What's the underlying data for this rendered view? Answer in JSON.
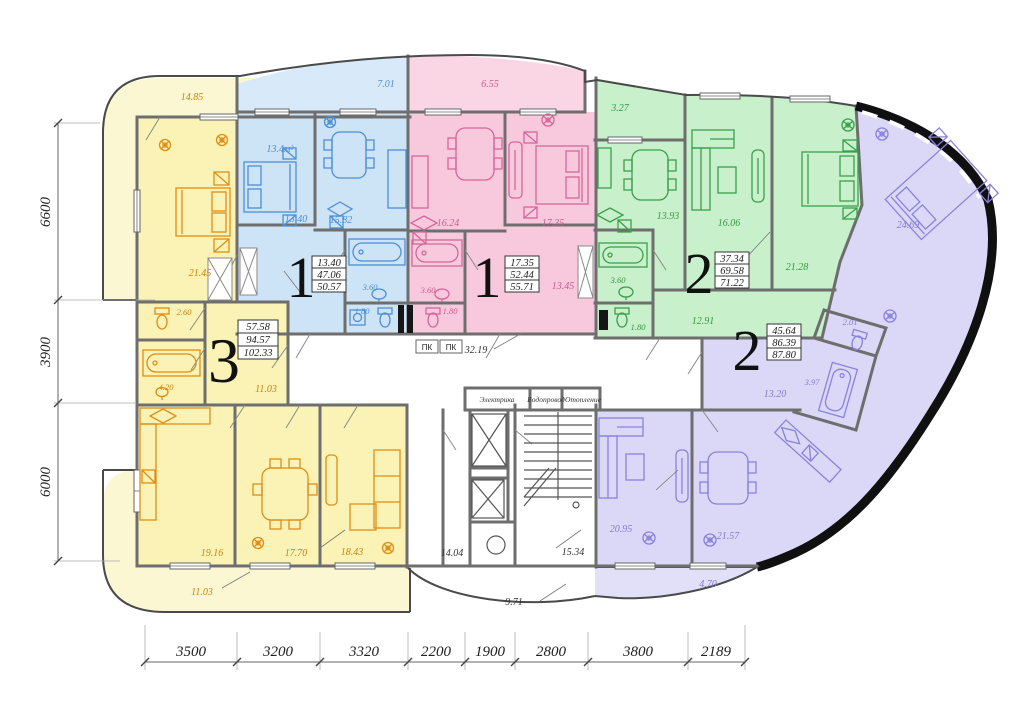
{
  "apartments": {
    "blue": {
      "number": "1",
      "area_rows": [
        "13.40",
        "47.06",
        "50.57"
      ],
      "rooms": {
        "balcony": "7.01",
        "bedroom_note": "13.4м²",
        "bedroom": "13.40",
        "kitchen": "15.82",
        "hall": "12.44",
        "bath": "3.60",
        "wc": "1.80"
      }
    },
    "pink": {
      "number": "1",
      "area_rows": [
        "17.35",
        "52.44",
        "55.71"
      ],
      "rooms": {
        "balcony": "6.55",
        "kitchen": "16.24",
        "bedroom": "17.35",
        "hall": "13.45",
        "bath": "3.60",
        "wc": "1.80"
      }
    },
    "green": {
      "number": "2",
      "area_rows": [
        "37.34",
        "69.58",
        "71.22"
      ],
      "rooms": {
        "balcony": "3.27",
        "kitchen": "13.93",
        "living": "16.06",
        "bedroom": "21.28",
        "hall": "12.91",
        "bath": "3.60",
        "wc": "1.80"
      }
    },
    "purple": {
      "number": "2",
      "area_rows": [
        "45.64",
        "86.39",
        "87.80"
      ],
      "rooms": {
        "bedroom": "24.69",
        "wc": "2.01",
        "bath": "3.97",
        "hall": "13.20",
        "living": "20.95",
        "kitchen": "21.57",
        "balcony": "4.70"
      }
    },
    "yellow": {
      "number": "3",
      "area_rows": [
        "57.58",
        "94.57",
        "102.33"
      ],
      "rooms": {
        "balcony_top": "14.85",
        "bedroom": "21.45",
        "wc": "2.60",
        "bath": "4.20",
        "hall": "11.03",
        "kitchen": "19.16",
        "dining": "17.70",
        "living": "18.43",
        "balcony_bottom": "11.03"
      }
    }
  },
  "common": {
    "corridor": "32.19",
    "elevator_lobby": "14.04",
    "stairwell": "15.34",
    "balcony": "9.71",
    "fire_cabinet": "ПК",
    "shaft_labels": [
      "Электрика",
      "Водопровод",
      "Отопление"
    ]
  },
  "dimensions": {
    "bottom": [
      "3500",
      "3200",
      "3320",
      "2200",
      "1900",
      "2800",
      "3800",
      "2189"
    ],
    "left": [
      "6600",
      "3900",
      "6000"
    ]
  },
  "colors": {
    "yellow": "#FAF3B5",
    "yellow_balcony": "#FBF7D2",
    "blue": "#CDE3F6",
    "blue_balcony": "#D8EAF9",
    "pink": "#F8C9DC",
    "pink_balcony": "#FAD6E4",
    "green": "#C7F0CB",
    "green_balcony": "#D4F4D7",
    "purple": "#DAD8F6",
    "purple_balcony": "#E2E0F8",
    "wall": "#6e6e6e",
    "exterior": "#101010"
  }
}
